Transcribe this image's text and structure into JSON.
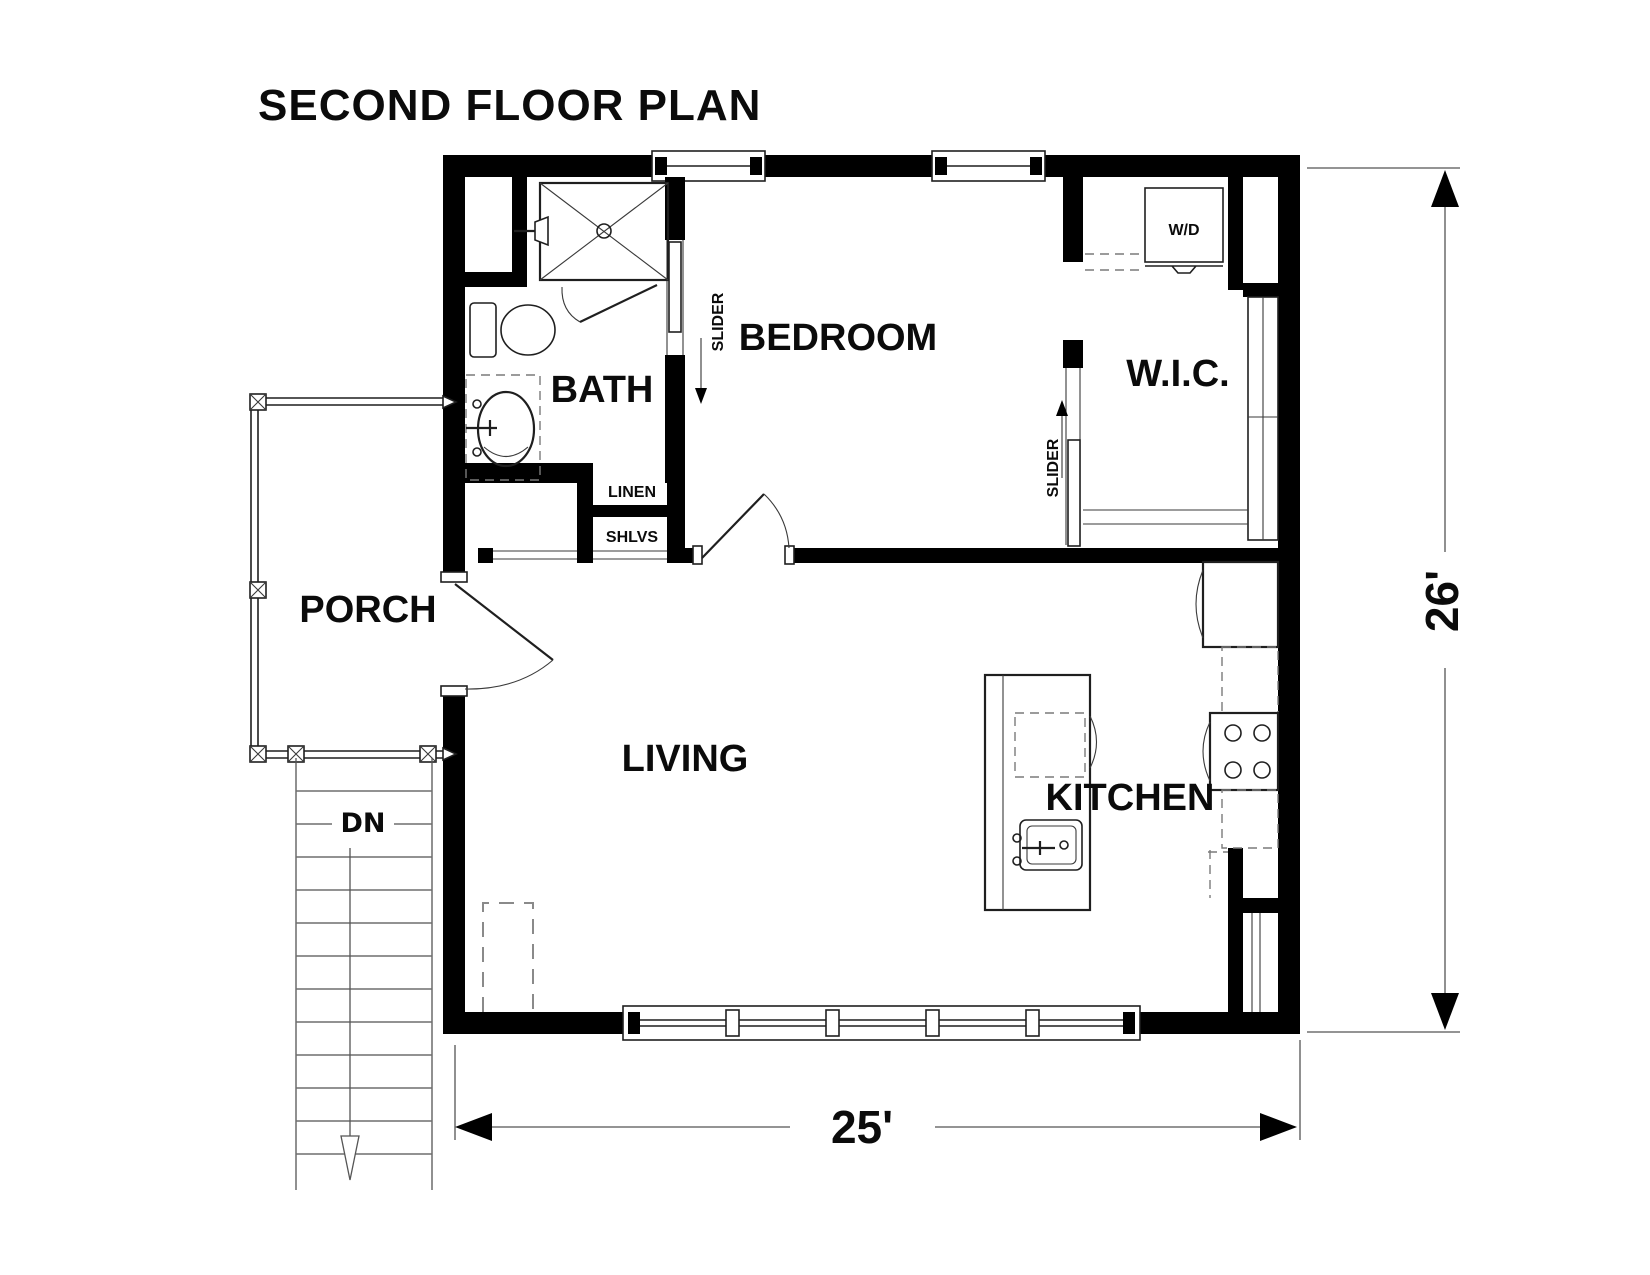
{
  "title": "SECOND FLOOR PLAN",
  "rooms": {
    "bath": "BATH",
    "bedroom": "BEDROOM",
    "wic": "W.I.C.",
    "porch": "PORCH",
    "living": "LIVING",
    "kitchen": "KITCHEN"
  },
  "annotations": {
    "slider": "SLIDER",
    "linen": "LINEN",
    "shelves": "SHLVS",
    "washer_dryer": "W/D",
    "stairs_down": "DN"
  },
  "dimensions": {
    "width": "25'",
    "height": "26'"
  },
  "colors": {
    "walls": "#000000",
    "lines": "#1f1f1f",
    "stairs": "#6e6e6e",
    "dashed": "#7a7a7a",
    "background": "#ffffff"
  }
}
